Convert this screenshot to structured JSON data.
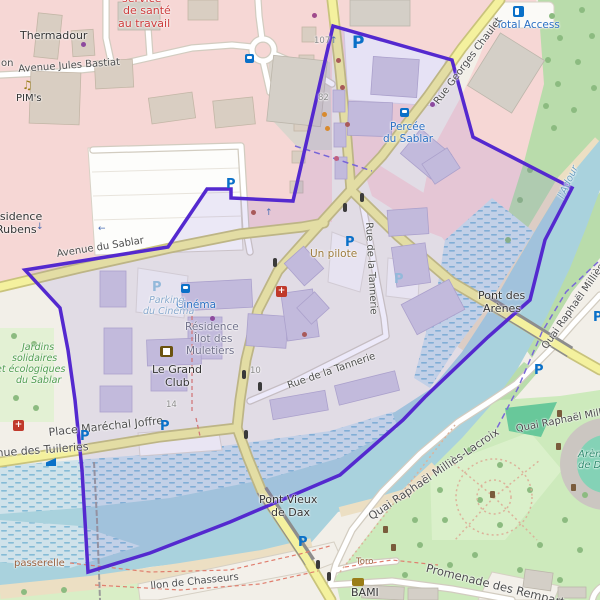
{
  "colors": {
    "boundary": "#5429cf",
    "water": "#a9d2dd",
    "road_primary": "#f4f19e",
    "pink_zone": "#f6d7d5",
    "park_green": "#cdeabc",
    "transit_blue": "#2a6fc2"
  },
  "icons": {
    "parking": "P",
    "cross": "+",
    "music_note": "♫",
    "arrow_up": "↑",
    "arrow_down": "↓",
    "arrow_left": "←"
  },
  "labels": {
    "thermadour": "Thermadour",
    "service_line1": "service",
    "service_line2": "de santé",
    "service_line3": "au travail",
    "avenue_jules_bastiat": "Avenue Jules Bastiat",
    "fragment_on": "on",
    "pims": "PIM's",
    "residence_line1": "Résidence",
    "residence_line2": "Rubens",
    "avenue_du_sablar": "Avenue du Sablar",
    "cinema": "Cinéma",
    "percee_line1": "Percée",
    "percee_line2": "du Sablar",
    "total_access": "Total Access",
    "rue_georges_chaulet": "Rue Georges Chaulet",
    "adour": "l'Adour",
    "un_pilote": "Un pilote",
    "rue_tannerie": "Rue de la Tannerie",
    "pont_arenes_line1": "Pont des",
    "pont_arenes_line2": "Arènes",
    "quai_rm_short": "Quai Raphaël Milliès-",
    "quai_rm_full": "Quai Raphaël Milliès-Lacroix",
    "pont_vieux_line1": "Pont Vieux",
    "pont_vieux_line2": "de Dax",
    "passerelle": "passerelle",
    "jardins_line1": "Jardins",
    "jardins_line2": "solidaires",
    "jardins_line3": "et écologiques",
    "jardins_line4": "du Sablar",
    "muletiers_line1": "Résidence",
    "muletiers_line2": "Îlot des",
    "muletiers_line3": "Muletiers",
    "grand_club_line1": "Le Grand",
    "grand_club_line2": "Club",
    "parking_cinema_line1": "Parking",
    "parking_cinema_line2": "du Cinéma",
    "place_marechal_joffre": "Place Maréchal Joffre",
    "avenue_des_tuileries": "Avenue des Tuileries",
    "chasseurs": "llon de Chasseurs",
    "promenade_remparts": "Promenade des Remparts",
    "toro": "Toro",
    "bami": "BAMI",
    "arenes_line1": "Arènes",
    "arenes_line2": "de Dax",
    "n107": "107",
    "n82": "82",
    "n14": "14",
    "n10": "10"
  }
}
